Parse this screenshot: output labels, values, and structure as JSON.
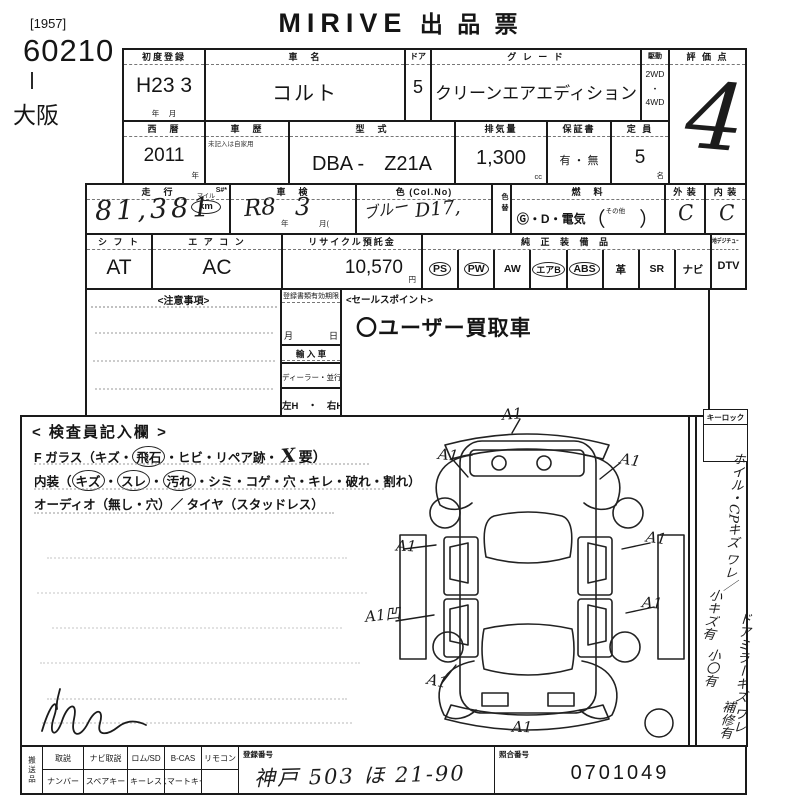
{
  "page": {
    "lot_bracket": "[1957]",
    "lot_number": "60210",
    "site": "大阪",
    "brand": "MIRIVE",
    "title": "出 品 票"
  },
  "row1": {
    "first_reg_label": "初度登録",
    "first_reg_value": "H23 3",
    "first_reg_unit": "年　 月",
    "name_label": "車　名",
    "name_value": "コルト",
    "door_label": "ドア",
    "door_value": "5",
    "grade_label": "グ レ ー ド",
    "grade_value": "クリーンエアエディション",
    "drive_label": "駆動",
    "drive_opt1": "2WD",
    "drive_dot": "・",
    "drive_opt2": "4WD",
    "score_label": "評 価 点",
    "score_value": "4"
  },
  "row2": {
    "year_label": "西　暦",
    "year_value": "2011",
    "year_unit": "年",
    "history_label": "車　歴",
    "history_note": "未記入は自家用",
    "model_label": "型　式",
    "model_value": "DBA -　Z21A",
    "disp_label": "排気量",
    "disp_value": "1,300",
    "disp_unit": "cc",
    "warranty_label": "保証書",
    "warranty_value": "有 ・ 無",
    "capacity_label": "定 員",
    "capacity_value": "5",
    "capacity_unit": "名"
  },
  "row3": {
    "mileage_label": "走　行",
    "mileage_smark": "S#*",
    "mileage_value": "81,381",
    "mileage_unit_top": "マイル",
    "mileage_unit": "km",
    "shaken_label": "車　検",
    "shaken_era": "R8",
    "shaken_year": "年",
    "shaken_month_value": "3",
    "shaken_month": "月(",
    "color_label": "色 (Col.No)",
    "color_value": "ブルー",
    "color_code": "D17,",
    "color_change": "色替",
    "fuel_label": "燃　料",
    "fuel_value": "Ⓖ・D・電気",
    "fuel_paren_open": "（",
    "fuel_other": "その他",
    "fuel_paren_close": "）",
    "exterior_label": "外 装",
    "exterior_value": "C",
    "interior_label": "内 装",
    "interior_value": "C"
  },
  "row4": {
    "shift_label": "シ フ ト",
    "shift_value": "AT",
    "aircon_label": "エ ア コ ン",
    "aircon_value": "AC",
    "recycle_label": "リサイクル預託金",
    "recycle_value": "10,570",
    "recycle_unit": "円",
    "equip_label": "純 正 装 備 品",
    "equip_items": [
      {
        "text": "PS"
      },
      {
        "text": "PW"
      },
      {
        "text": "AW"
      },
      {
        "text": "エアB"
      },
      {
        "text": "ABS"
      },
      {
        "text": "革"
      },
      {
        "text": "SR"
      },
      {
        "text": "ナビ"
      }
    ],
    "dtv_header": "地デジチューナー有",
    "dtv_value": "DTV"
  },
  "notices": {
    "label": "<注意事項>"
  },
  "docs": {
    "expiry_label": "登録書類有効期限",
    "expiry_units": "月　　　　日",
    "import_label": "輸 入 車",
    "import_type": "ディーラー・並行",
    "handle": "左H　・　右H"
  },
  "sales": {
    "label": "<セールスポイント>",
    "value": "〇ユーザー買取車"
  },
  "inspect": {
    "title": "< 検査員記入欄 >",
    "glass_pre": "F ガラス（キズ・",
    "glass_circled": "飛石",
    "glass_mid": "・ヒビ・リペア跡・",
    "glass_x": "X",
    "glass_post": "要）",
    "interior_pre": "内装（",
    "interior_c1": "キズ",
    "interior_d1": "・",
    "interior_c2": "スレ",
    "interior_d2": "・",
    "interior_c3": "汚れ",
    "interior_post": "・シミ・コゲ・穴・キレ・破れ・割れ）",
    "audio_line": "オーディオ（無し・穴）／ タイヤ（スタッドレス）",
    "annotations": [
      {
        "text": "A1"
      },
      {
        "text": "A1"
      },
      {
        "text": "A1"
      },
      {
        "text": "A1"
      },
      {
        "text": "A1"
      },
      {
        "text": "A1凹"
      },
      {
        "text": "A1"
      },
      {
        "text": "A1"
      },
      {
        "text": "A1"
      }
    ]
  },
  "sidebar": {
    "keylock": "キーロック",
    "notes": [
      {
        "text": "ホイル・CPキズ ワレ／"
      },
      {
        "text": "小キズ有"
      },
      {
        "text": "ドアミラーキズ ワレ"
      },
      {
        "text": "小〇有"
      },
      {
        "text": "補修有"
      }
    ]
  },
  "bottom": {
    "carry_label": "搬送品",
    "row1": [
      {
        "text": "取説"
      },
      {
        "text": "ナビ取説"
      },
      {
        "text": "ロム/SD"
      },
      {
        "text": "B-CAS"
      },
      {
        "text": "リモコン"
      }
    ],
    "row2": [
      {
        "text": "ナンバー"
      },
      {
        "text": "スペアキー"
      },
      {
        "text": "キーレス"
      },
      {
        "text": "スマートキー"
      },
      {
        "text": ""
      }
    ],
    "reg_label": "登録番号",
    "reg_value": "神戸 503 ほ 21-90",
    "ref_label": "照合番号",
    "ref_value": "0701049"
  }
}
